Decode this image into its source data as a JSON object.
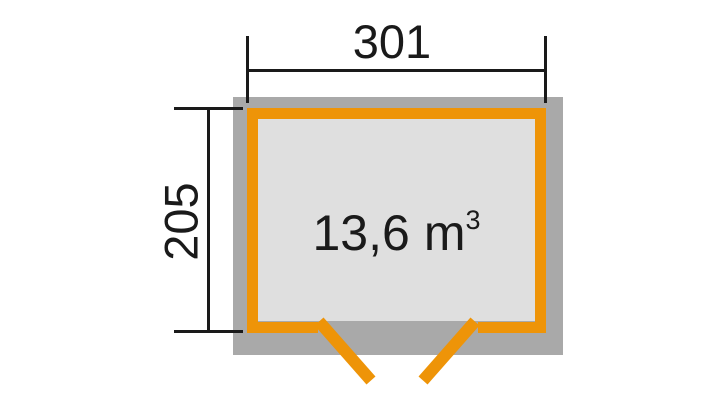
{
  "diagram": {
    "type": "shed-floor-plan",
    "dimensions": {
      "width": {
        "label": "301"
      },
      "height": {
        "label": "205"
      }
    },
    "volume": {
      "value": "13,6",
      "unit": "m",
      "exponent": "3"
    }
  },
  "colors": {
    "background": "#ffffff",
    "wall": "#a9a9a9",
    "interior": "#dfdfdf",
    "outline": "#ee9408",
    "line": "#1a1a1a",
    "text": "#1a1a1a"
  }
}
